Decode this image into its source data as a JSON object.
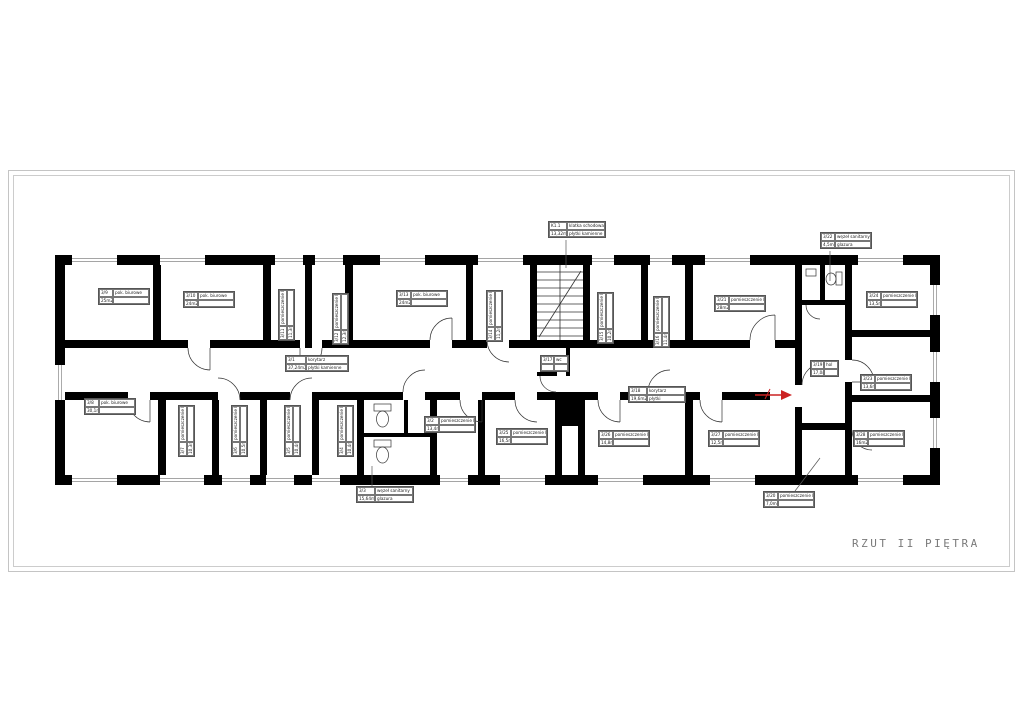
{
  "title": "RZUT II PIĘTRA",
  "colors": {
    "wall": "#000000",
    "thin_line": "#444444",
    "window_line": "#888888",
    "frame": "#c4c4c4",
    "title_text": "#7a7a7a",
    "entrance_arrow": "#cc2222"
  },
  "rooms": [
    {
      "id": "3/9",
      "name": "pok. biurowe",
      "area": "25m2",
      "finish": ""
    },
    {
      "id": "3/10",
      "name": "pok. biurowe",
      "area": "24m2",
      "finish": ""
    },
    {
      "id": "3/11",
      "name": "pomieszczenie biurowe",
      "area": "11,3m2",
      "finish": ""
    },
    {
      "id": "3/12",
      "name": "pomieszczenie biurowe",
      "area": "12,3m2",
      "finish": ""
    },
    {
      "id": "3/13",
      "name": "pok. biurowe",
      "area": "24m2",
      "finish": ""
    },
    {
      "id": "3/14",
      "name": "pomieszczenie biurowe",
      "area": "11,2m2",
      "finish": ""
    },
    {
      "id": "K1.1",
      "name": "klatka schodowa",
      "area": "13,32m2",
      "finish": "płytki kamienne"
    },
    {
      "id": "3/15",
      "name": "pomieszczenie biurowe",
      "area": "10,2m2",
      "finish": ""
    },
    {
      "id": "3/16",
      "name": "pomieszczenie biurowe",
      "area": "11,4m2",
      "finish": ""
    },
    {
      "id": "3/21",
      "name": "pomieszczenie biurowe",
      "area": "28m2",
      "finish": ""
    },
    {
      "id": "3/22",
      "name": "węzeł sanitarny",
      "area": "4,5m2",
      "finish": "glazura"
    },
    {
      "id": "3/24",
      "name": "pomieszczenie biurowe",
      "area": "13,5m2",
      "finish": ""
    },
    {
      "id": "3/1",
      "name": "korytarz",
      "area": "37,24m2",
      "finish": "płytki kamienne"
    },
    {
      "id": "3/17",
      "name": "wc",
      "area": "",
      "finish": ""
    },
    {
      "id": "3/18",
      "name": "korytarz",
      "area": "19,6m2",
      "finish": "płytki"
    },
    {
      "id": "3/19",
      "name": "hol",
      "area": "17,0m2",
      "finish": ""
    },
    {
      "id": "3/23",
      "name": "pomieszczenie biurowe",
      "area": "13,6m2",
      "finish": ""
    },
    {
      "id": "3/8",
      "name": "pok. biurowe",
      "area": "30,1m2",
      "finish": ""
    },
    {
      "id": "3/7",
      "name": "pomieszczenie biurowe",
      "area": "10,3m2",
      "finish": ""
    },
    {
      "id": "3/6",
      "name": "pomieszczenie biurowe",
      "area": "10,5m2",
      "finish": ""
    },
    {
      "id": "3/5",
      "name": "pomieszczenie biurowe",
      "area": "10,4m2",
      "finish": ""
    },
    {
      "id": "3/4",
      "name": "pomieszczenie biurowe",
      "area": "10,4m2",
      "finish": ""
    },
    {
      "id": "3/3",
      "name": "węzeł sanitarny",
      "area": "15,64m2",
      "finish": "glazura"
    },
    {
      "id": "3/2",
      "name": "pomieszczenie biurowe",
      "area": "13,4m2",
      "finish": ""
    },
    {
      "id": "3/25",
      "name": "pomieszczenie biurowe",
      "area": "16,5m2",
      "finish": ""
    },
    {
      "id": "3/26",
      "name": "pomieszczenie biurowe",
      "area": "14,8m2",
      "finish": ""
    },
    {
      "id": "3/27",
      "name": "pomieszczenie biurowe",
      "area": "12,5m2",
      "finish": ""
    },
    {
      "id": "3/28",
      "name": "pomieszczenie biurowe",
      "area": "16m2",
      "finish": ""
    },
    {
      "id": "3/20",
      "name": "pomieszczenie biurowe",
      "area": "7,0m2",
      "finish": ""
    }
  ]
}
